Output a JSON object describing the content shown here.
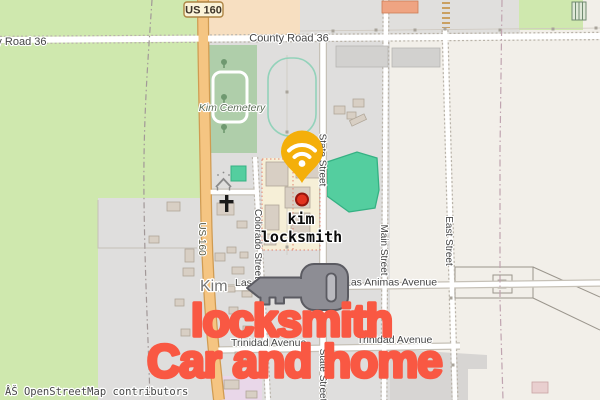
{
  "map": {
    "attribution": "ÂŠ OpenStreetMap contributors",
    "town": "Kim",
    "poi": {
      "line1": "kim",
      "line2": "locksmith"
    },
    "overlay": {
      "line1": "locksmith",
      "line2": "Car and home"
    },
    "labels": {
      "us160": "US 160",
      "county_road_36": "County Road 36",
      "state_street": "State Street",
      "colorado_street": "Colorado Street",
      "main_street": "Main Street",
      "east_street": "East Street",
      "las_animas_avenue": "Las Animas Avenue",
      "trinidad_avenue": "Trinidad Avenue",
      "kim_cemetery": "Kim Cemetery"
    },
    "colors": {
      "pin_amber": "#f4af0a",
      "marker_red": "#e2331f",
      "key_gray": "#8d8d94",
      "overlay_red": "#f95843",
      "pond_teal": "#54ce9f",
      "grass_green": "#cfe8ae",
      "residential_gray": "#dfdedd",
      "highway_tan": "#f5c582"
    }
  }
}
